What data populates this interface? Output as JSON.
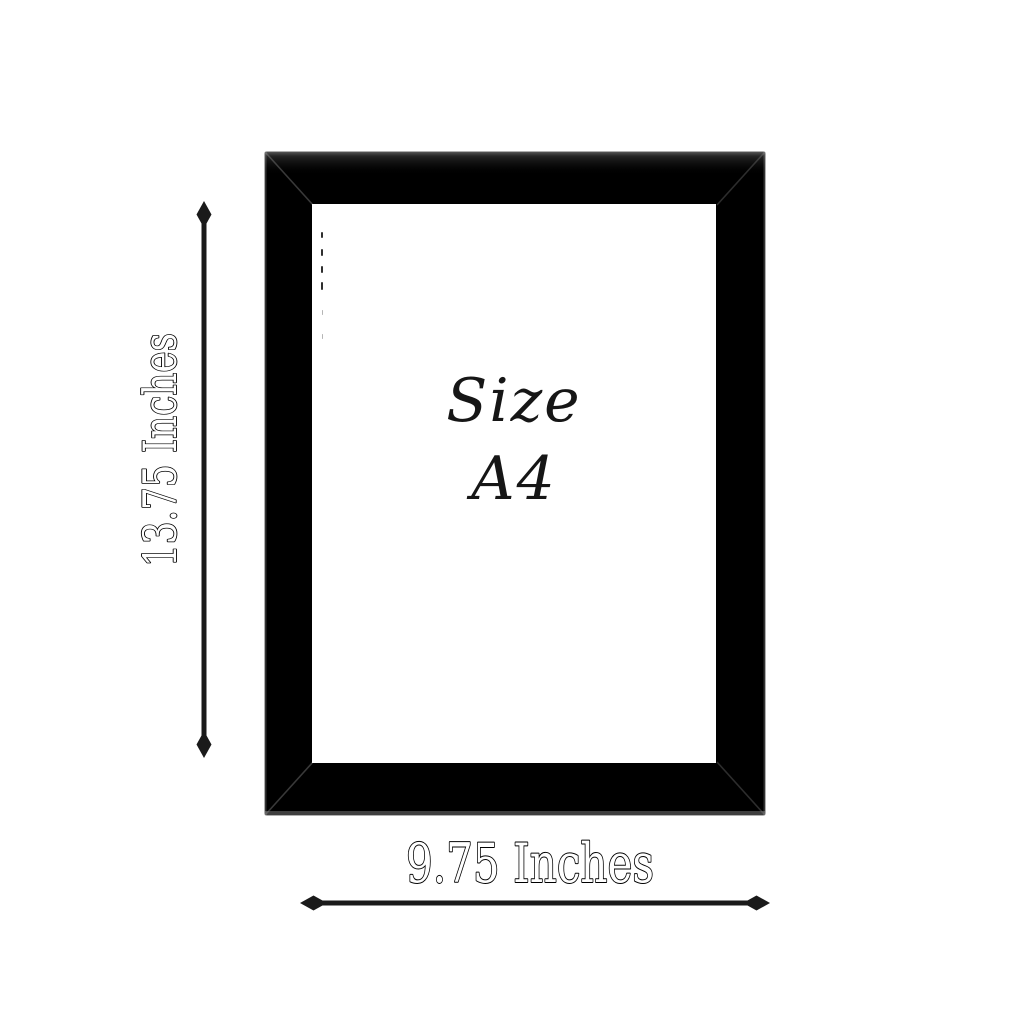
{
  "background_color": "#ffffff",
  "frame": {
    "color": "#000000",
    "window_color": "#ffffff",
    "label_line1": "Size",
    "label_line2": "A4"
  },
  "dimensions": {
    "height_label": "13.75 Inches",
    "width_label": "9.75 Inches",
    "annotation_color": "#1a1a1a"
  }
}
